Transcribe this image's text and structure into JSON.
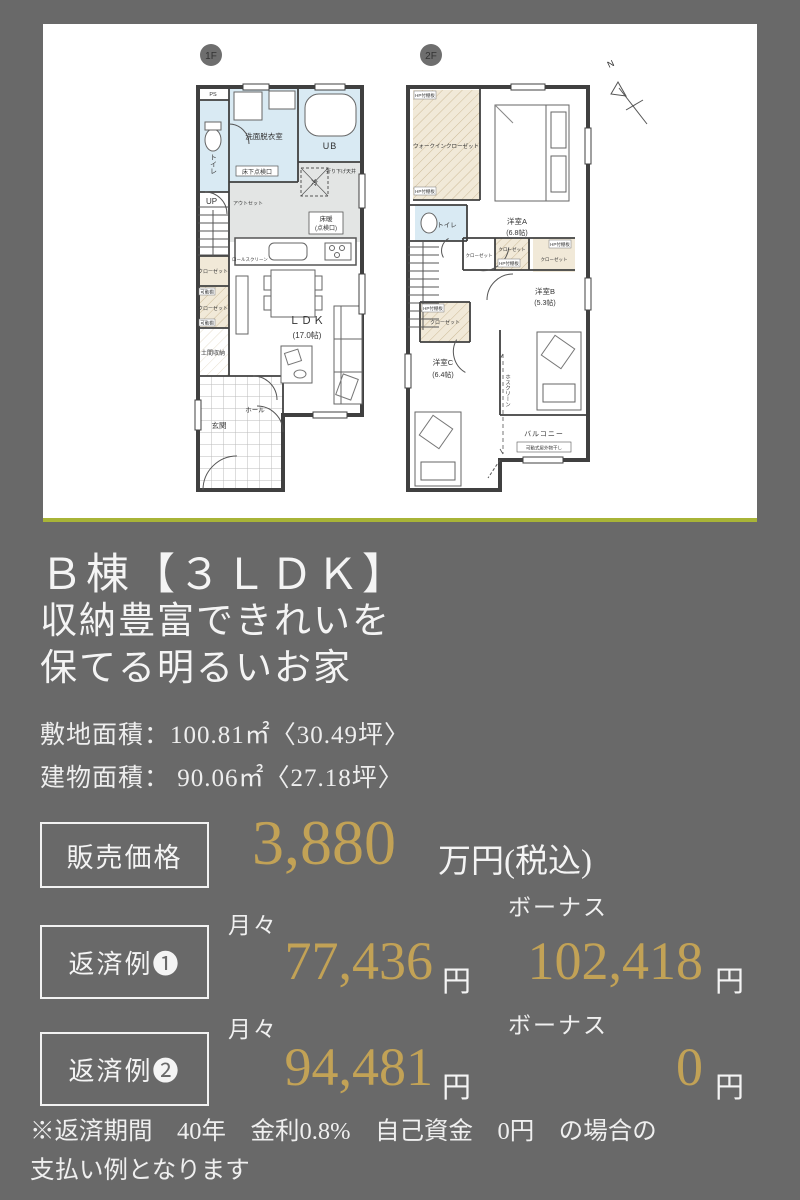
{
  "colors": {
    "background": "#696969",
    "accent_gold": "#c2a256",
    "panel_green_line": "#a8b437",
    "wet_room_blue": "#d9eaf3",
    "closet_beige": "#f1e9d8",
    "kitchen_gray": "#e3e5e4"
  },
  "plan": {
    "f1": {
      "badge": "1F",
      "ps": "PS",
      "toilet": "トイレ",
      "washroom": "洗面脱衣室",
      "underfloor": "床下点検口",
      "ub": "UB",
      "outset": "アウトセット",
      "up": "UP",
      "closet": "クローゼット",
      "rollscreen": "ロールスクリーン",
      "movable": "可動棚",
      "doma": "土間収納",
      "ldk": "ＬＤＫ",
      "ldk_size": "(17.0帖)",
      "fridge": "冷",
      "yukadan": "床暖",
      "tenkenko": "(点検口)",
      "ceiling": "折り下げ天井",
      "genkan": "玄関",
      "hall": "ホール"
    },
    "f2": {
      "badge": "2F",
      "north": "N",
      "wic": "ウォークインクローゼット",
      "shelf": "HP付棚板",
      "toilet": "トイレ",
      "roomA": "洋室A",
      "roomA_size": "(6.8帖)",
      "closet": "クローゼット",
      "roomB": "洋室B",
      "roomB_size": "(5.3帖)",
      "roomC": "洋室C",
      "roomC_size": "(6.4帖)",
      "hoscreen": "ホスクリーン",
      "balcony": "バルコニー",
      "drying": "可動式屋外物干し"
    }
  },
  "info": {
    "title": "Ｂ棟【３ＬＤＫ】",
    "subtitle1": "収納豊富できれいを",
    "subtitle2": "保てる明るいお家",
    "site_area": "敷地面積：100.81㎡〈30.49坪〉",
    "building_area": "建物面積： 90.06㎡〈27.18坪〉"
  },
  "price": {
    "label": "販売価格",
    "value": "3,880",
    "unit": "万円(税込)"
  },
  "repayments": [
    {
      "label": "返済例❶",
      "monthly_label": "月々",
      "monthly": "77,436",
      "monthly_unit": "円",
      "bonus_label": "ボーナス",
      "bonus": "102,418",
      "bonus_unit": "円"
    },
    {
      "label": "返済例❷",
      "monthly_label": "月々",
      "monthly": "94,481",
      "monthly_unit": "円",
      "bonus_label": "ボーナス",
      "bonus": "0",
      "bonus_unit": "円"
    }
  ],
  "note": {
    "line1": "※返済期間　40年　金利0.8%　自己資金　0円　の場合の",
    "line2": "支払い例となります"
  }
}
